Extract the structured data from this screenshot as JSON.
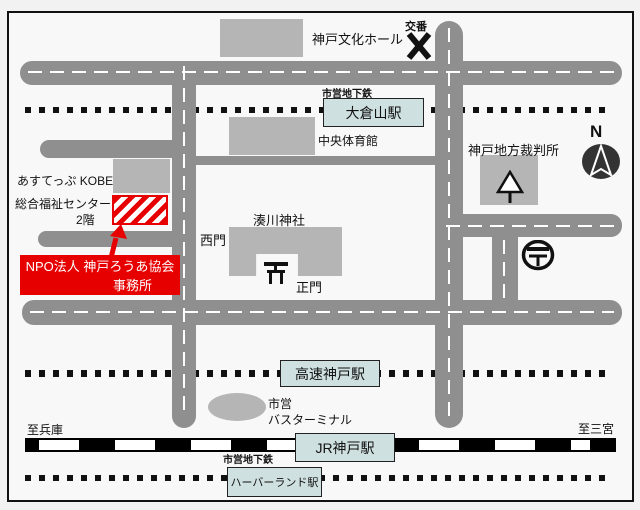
{
  "colors": {
    "road": "#8f8f8f",
    "building": "#b5b5b5",
    "station_fill": "#cfe0e0",
    "accent_red": "#e60000",
    "rail": "#000000",
    "background": "#f8f8f8"
  },
  "labels": {
    "culture_hall": "神戸文化ホール",
    "koban": "交番",
    "subway_top": "市営地下鉄",
    "gym": "中央体育館",
    "court": "神戸地方裁判所",
    "compass_n": "N",
    "asutep": "あすてっぷ KOBE",
    "fukushi_center": "総合福祉センター",
    "floor2": "2階",
    "shrine": "湊川神社",
    "west_gate": "西門",
    "main_gate": "正門",
    "shiei": "市営",
    "bus_terminal": "バスターミナル",
    "to_hyogo": "至兵庫",
    "to_sannomiya": "至三宮",
    "subway_bottom": "市営地下鉄"
  },
  "stations": {
    "okurayama": "大倉山駅",
    "kosoku_kobe": "高速神戸駅",
    "jr_kobe": "JR神戸駅",
    "harborland": "ハーバーランド駅"
  },
  "destination": {
    "line1": "NPO法人 神戸ろうあ協会",
    "line2": "事務所"
  },
  "icons": {
    "koban": "x-mark",
    "shrine_gate": "torii",
    "court": "arrow-tree",
    "post_office": "postal-mark-circle",
    "compass": "north-needle",
    "pointer": "red-arrow"
  }
}
